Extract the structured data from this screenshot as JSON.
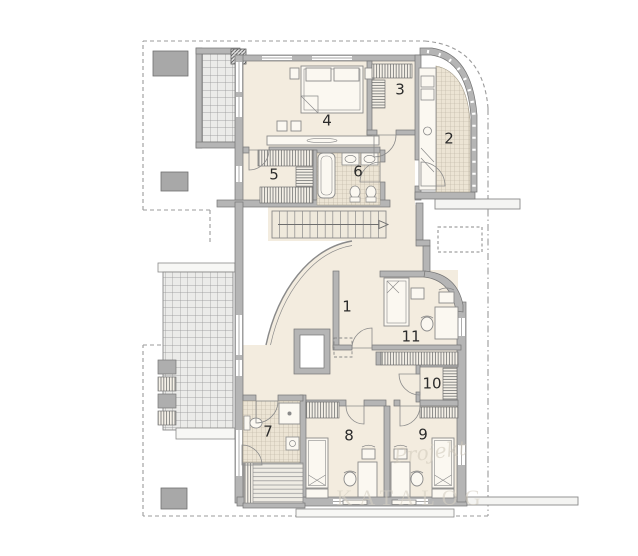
{
  "plan": {
    "type": "architectural-floor-plan",
    "floor": "upper storey",
    "rooms": [
      {
        "number": "1"
      },
      {
        "number": "2"
      },
      {
        "number": "3"
      },
      {
        "number": "4"
      },
      {
        "number": "5"
      },
      {
        "number": "6"
      },
      {
        "number": "7"
      },
      {
        "number": "8"
      },
      {
        "number": "9"
      },
      {
        "number": "10"
      },
      {
        "number": "11"
      }
    ],
    "watermark": {
      "script_text": "Projekt",
      "caps_text": "KATALOG"
    },
    "colors": {
      "wall": "#b5b5b5",
      "wall_outline": "#757575",
      "floor": "#f3ecdf",
      "tile_floor": "#ece4d4",
      "balcony_grid": "#ebebe9",
      "grid_line": "#909090",
      "dashed_roof_line": "#9b9b9b",
      "chimney": "#a8a8a8",
      "label_text": "#2b2b2b",
      "watermark": "#d6d0c4"
    }
  }
}
